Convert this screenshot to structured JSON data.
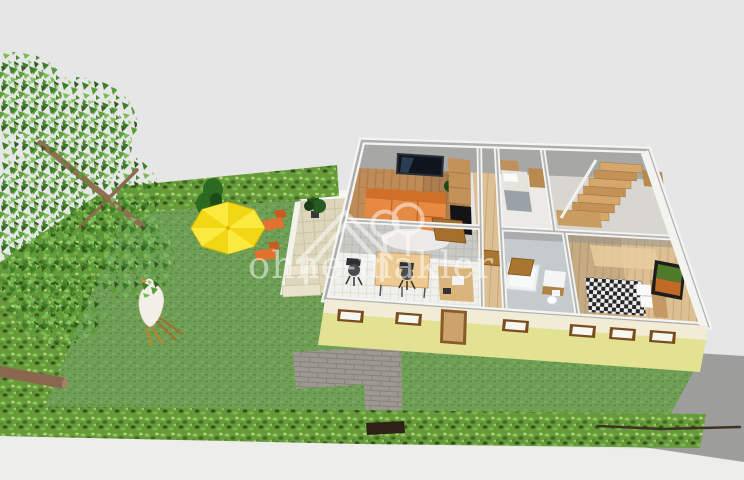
{
  "watermark": {
    "text": "ohne-makler",
    "logo": "house-and-trees-icon",
    "color": "#ffffff",
    "opacity": 0.5
  },
  "scene": {
    "kind": "3d-floorplan-garden-render",
    "rooms": [
      "living-room",
      "kitchen-dining",
      "hallway",
      "small-bedroom",
      "staircase-room",
      "bathroom",
      "bedroom"
    ],
    "garden_objects": [
      "large-tree",
      "hedge-border",
      "lawn",
      "sun-umbrella",
      "conifer-shrub",
      "orange-loungers",
      "chicken",
      "terrace",
      "paved-path",
      "garden-gate",
      "driveway",
      "fallen-branches",
      "log",
      "stick"
    ]
  },
  "palette": {
    "background": "#e6e6e6",
    "ground_outside": "#ededeb",
    "grass": "#6f9e55",
    "hedge": "#67993c",
    "tree_leaf": "#4a8a33",
    "umbrella": "#f6df1f",
    "lounger_orange": "#e2702f",
    "sofa_orange": "#e68a43",
    "wall_cut_gray": "#a7a7a5",
    "wall_white": "#f4f4f2",
    "facade_yellow": "#e2e292",
    "facade_cream": "#f1ecd6",
    "wood_floor": "#bf8c58",
    "wood_light": "#dcbf92",
    "path_brick": "#9d9890",
    "driveway": "#9d9d9b",
    "terrace_tile": "#ded6bb"
  }
}
